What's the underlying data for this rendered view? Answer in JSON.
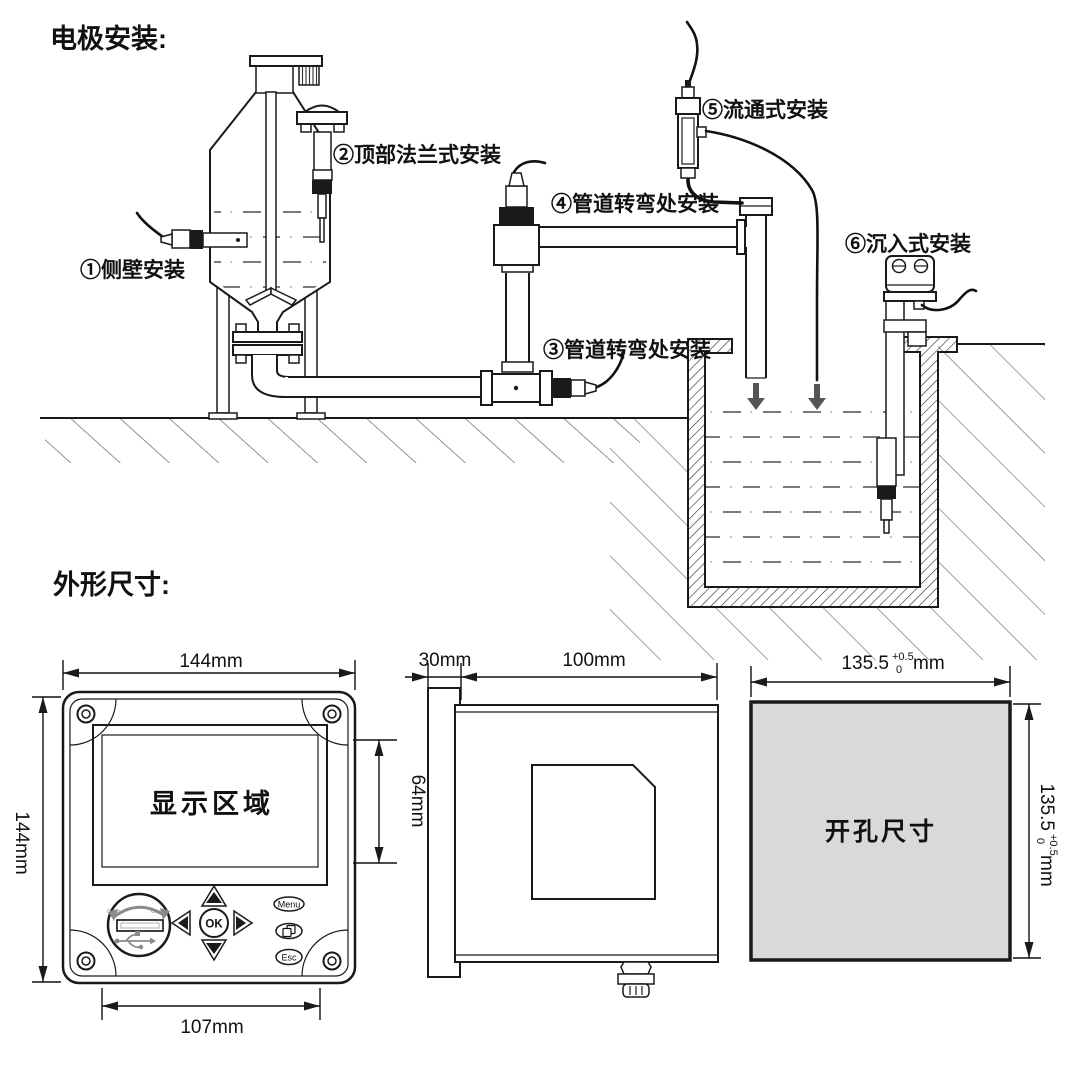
{
  "page": {
    "electrode_section_title": "电极安装:",
    "dimension_section_title": "外形尺寸:"
  },
  "installations": [
    {
      "label": "①侧壁安装"
    },
    {
      "label": "②顶部法兰式安装"
    },
    {
      "label": "③管道转弯处安装"
    },
    {
      "label": "④管道转弯处安装"
    },
    {
      "label": "⑤流通式安装"
    },
    {
      "label": "⑥沉入式安装"
    }
  ],
  "front_view": {
    "top_width": "144mm",
    "left_height": "144mm",
    "display_label": "显示区域",
    "display_height": "64mm",
    "bottom_width": "107mm",
    "usb": {
      "open": "Open",
      "close": "Close"
    },
    "buttons": {
      "ok": "OK",
      "menu": "Menu",
      "esc": "Esc"
    }
  },
  "side_view": {
    "bezel_depth": "30mm",
    "body_depth": "100mm"
  },
  "cutout_view": {
    "label": "开孔尺寸",
    "fill_color": "#d9d9d9",
    "width": {
      "value": "135.5",
      "tol_plus": "+0.5",
      "tol_zero": "0",
      "unit": "mm"
    },
    "height": {
      "value": "135.5",
      "tol_plus": "+0.5",
      "tol_zero": "0",
      "unit": "mm"
    }
  }
}
